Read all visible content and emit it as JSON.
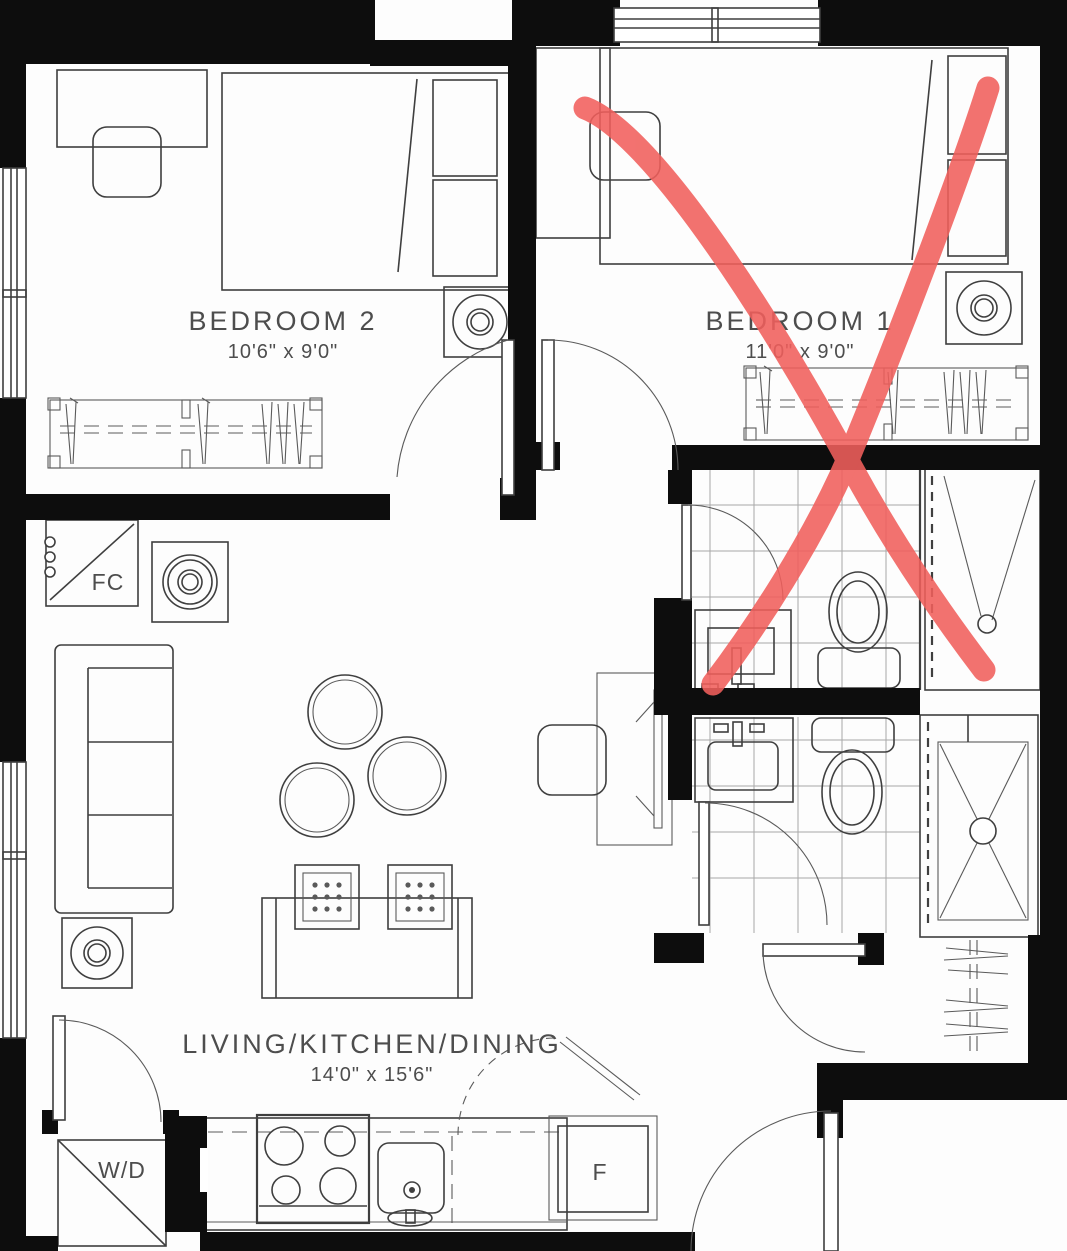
{
  "rooms": {
    "bedroom2": {
      "name": "BEDROOM 2",
      "dimensions": "10'6\" x 9'0\""
    },
    "bedroom1": {
      "name": "BEDROOM 1",
      "dimensions": "11'0\" x 9'0\""
    },
    "living": {
      "name": "LIVING/KITCHEN/DINING",
      "dimensions": "14'0\" x 15'6\""
    }
  },
  "labels": {
    "fan_coil": "FC",
    "washer_dryer": "W/D",
    "fridge": "F"
  },
  "annotation": {
    "shape": "X",
    "over": "BEDROOM 1"
  },
  "colors": {
    "wall": "#0d0d0d",
    "line": "#3f3f3f",
    "tile_grid": "#a8a8a8",
    "red_annotation": "#f15f5c",
    "background": "#fdfdfd",
    "text": "#4d4d4d"
  }
}
